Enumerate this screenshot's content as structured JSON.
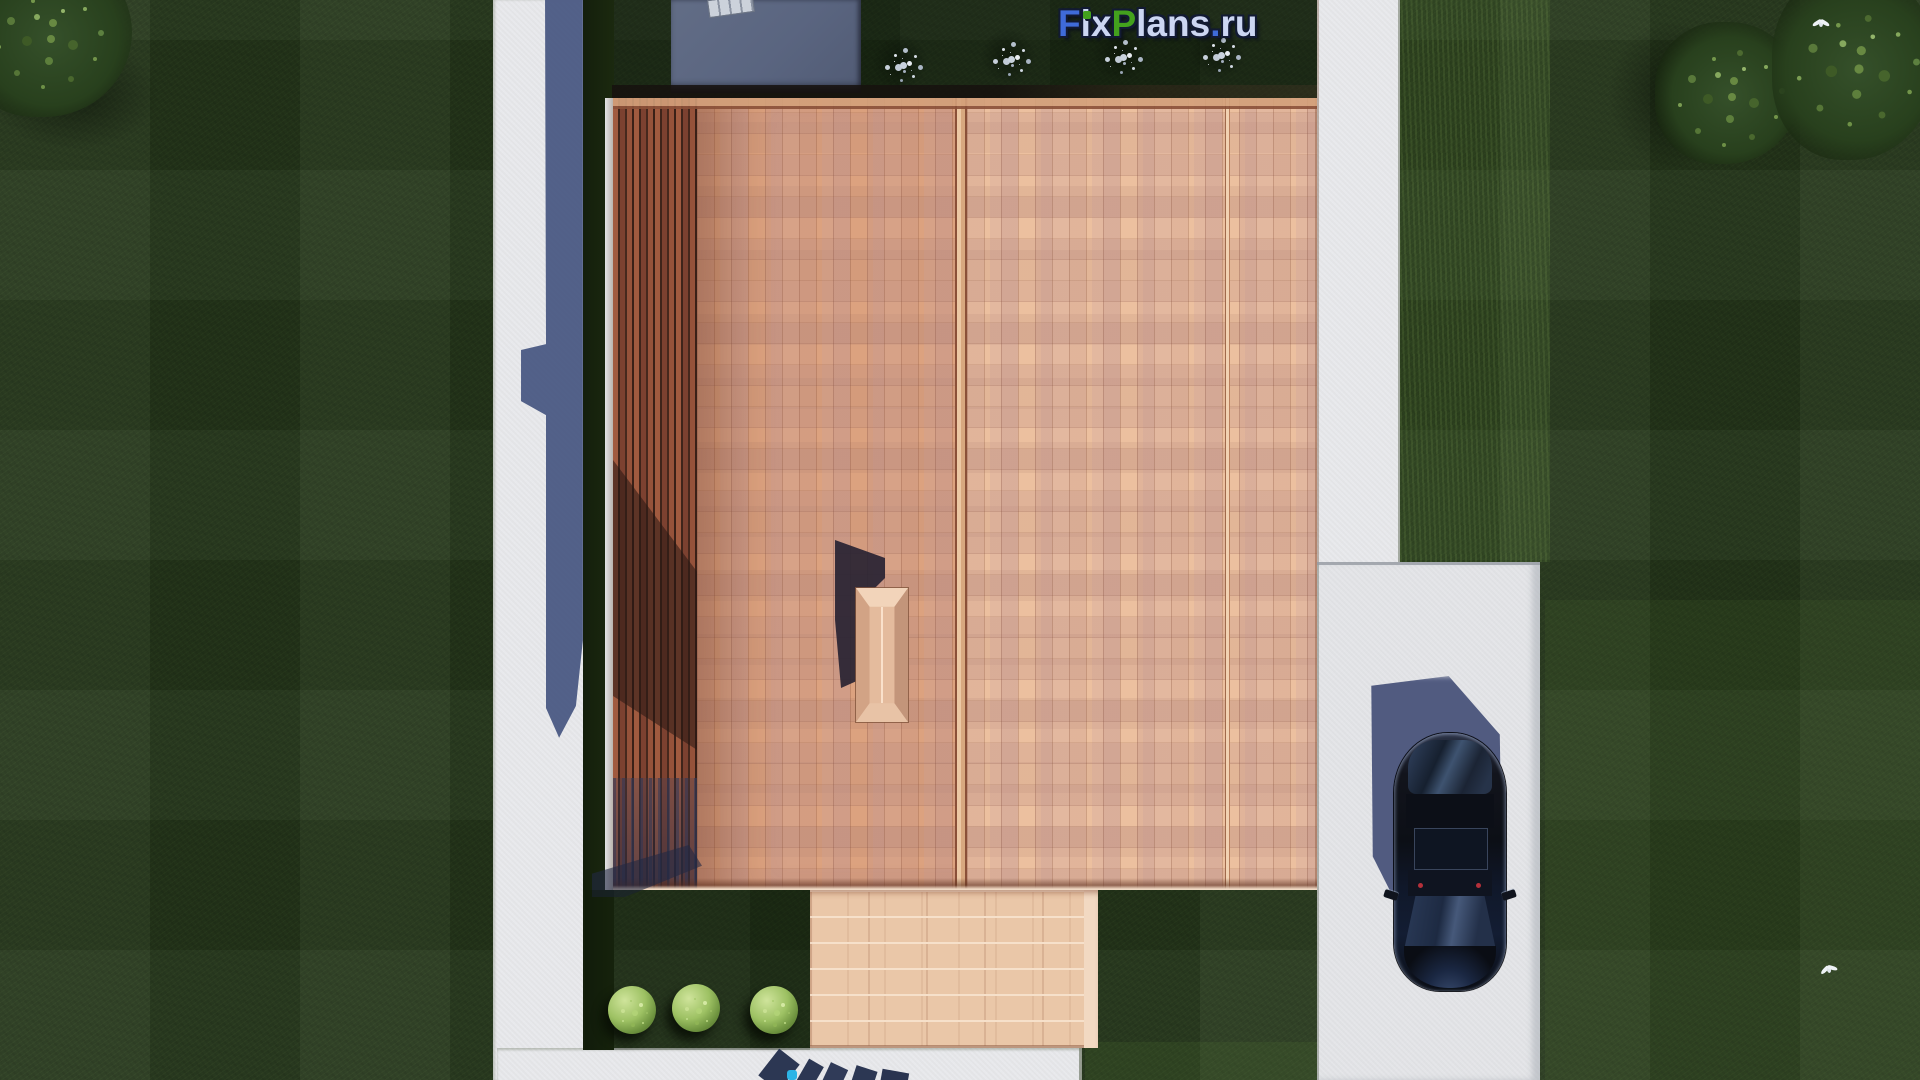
{
  "meta": {
    "title": "Aerial site plan 3D render — house with terracotta roof, driveway and car",
    "branding": "FixPlans.ru"
  },
  "logo": {
    "segments": [
      {
        "text": "F",
        "color": "#3f6bd9"
      },
      {
        "text": "i",
        "color": "#ccd6f2"
      },
      {
        "text": "x",
        "color": "#ccd6f2"
      },
      {
        "text": "P",
        "color": "#43a11d"
      },
      {
        "text": "lans",
        "color": "#ccd6f2"
      },
      {
        "text": ".",
        "color": "#3f6bd9"
      },
      {
        "text": "ru",
        "color": "#ccd6f2"
      }
    ],
    "i_dot_color": "#43a11d",
    "outline_color": "#121a33"
  },
  "scene": {
    "palette": {
      "grass_dark": "#26381c",
      "grass_light": "#33491f",
      "concrete_path": "#e8e9ec",
      "driveway": "#e4e5e8",
      "building_shadow_blue": "#4c5b84",
      "flat_roof_gray": "#5d6880",
      "roof_slats_dark": "#8f4d36",
      "roof_shingle_mid": "#dca27f",
      "roof_shingle_right": "#ecc09f",
      "roof_mauve_patch": "#c9a29e",
      "terrace_pavers": "#eac7a8",
      "chimney": "#e4bb9d",
      "car_body": "#0d1117",
      "car_glass": "#223048",
      "car_shadow": "#49547b",
      "bush_green": "#9dc163",
      "bush_white": "#cdd5e0",
      "watermark_accent": "#2cb4e6"
    },
    "objects": {
      "house_roof": "hipped roof with terracotta shingles, three sections and left slatted pergola wing",
      "chimney": "hipped chimney casting shadow up-left",
      "car": "dark sedan parked on right driveway, top view",
      "terrace": "pale paver terrace at south entrance",
      "green_bushes_count": 3,
      "white_flower_bushes_count": 4,
      "trees": "one top-left, two top-right",
      "birds": "white bird on top-right tree, white bird on bottom-right lawn"
    }
  }
}
